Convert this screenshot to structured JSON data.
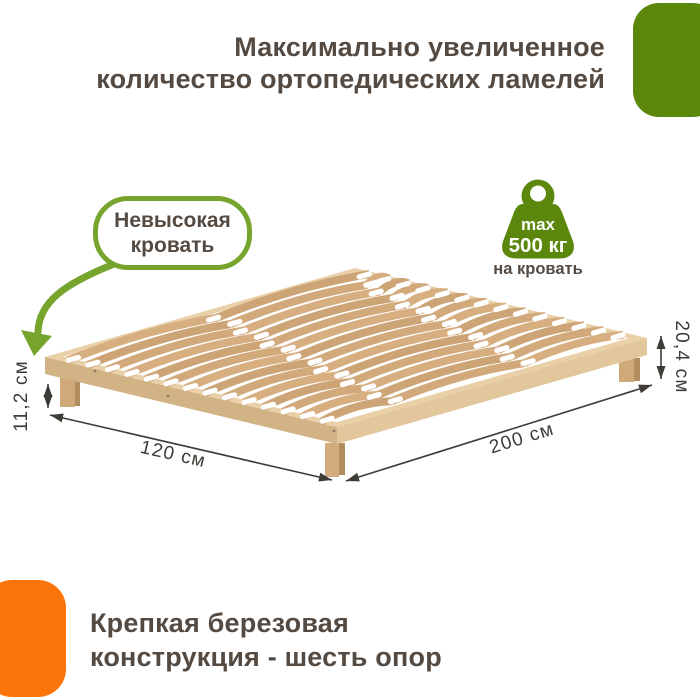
{
  "header": {
    "title_line1": "Максимально увеличенное",
    "title_line2": "количество ортопедических ламелей"
  },
  "callout": {
    "line1": "Невысокая",
    "line2": "кровать"
  },
  "weight_badge": {
    "max_label": "max",
    "value": "500 кг",
    "caption": "на кровать"
  },
  "dimensions": {
    "under_bed_height": "11,2 см",
    "total_height": "20,4 см",
    "width": "120 см",
    "length": "200 см"
  },
  "footer": {
    "line1": "Крепкая березовая",
    "line2": "конструкция - шесть опор"
  },
  "colors": {
    "green": "#5b870d",
    "green_light": "#76a42c",
    "orange": "#fb7409",
    "text_dark": "#554a42",
    "dimension_dark": "#3f3b37",
    "slat_wood": "#d3a97a",
    "rail_wood": "#e9d0a8"
  },
  "icons": {
    "weight_icon": "kettlebell-weight",
    "callout_arrow": "curved-arrow-down-left"
  }
}
